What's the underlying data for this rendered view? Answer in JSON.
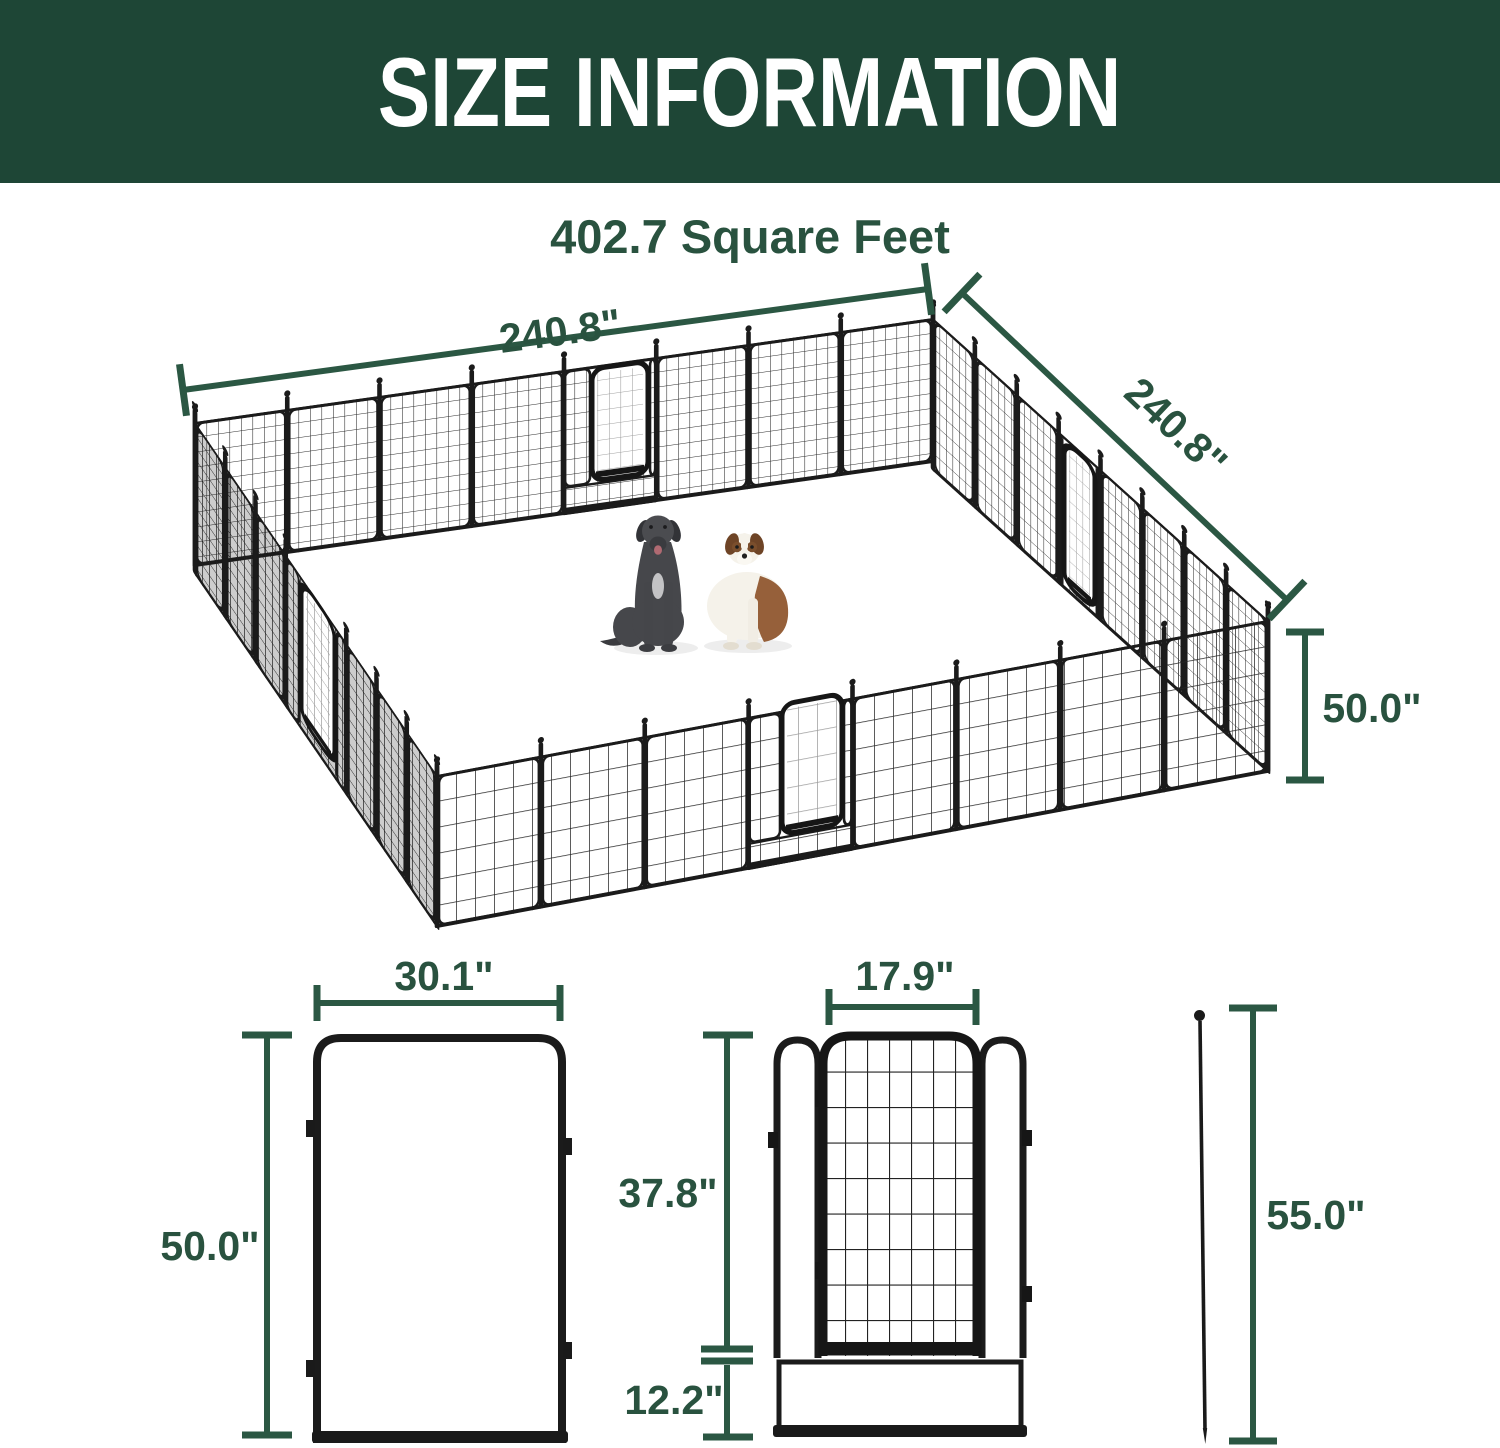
{
  "header": {
    "title": "SIZE INFORMATION"
  },
  "subtitle": "402.7 Square Feet",
  "pen": {
    "top_width_label": "240.8\"",
    "side_depth_label": "240.8\"",
    "panel_height_label": "50.0\""
  },
  "panel_diagram": {
    "width_label": "30.1\"",
    "height_label": "50.0\""
  },
  "gate_diagram": {
    "door_width_label": "17.9\"",
    "door_height_label": "37.8\"",
    "bottom_height_label": "12.2\""
  },
  "stake_diagram": {
    "length_label": "55.0\""
  },
  "theme": {
    "header_bg": "#1e4636",
    "header_text": "#ffffff",
    "dim_color": "#2b5743",
    "label_color": "#29523f",
    "mesh_color": "#1b1b1b"
  }
}
